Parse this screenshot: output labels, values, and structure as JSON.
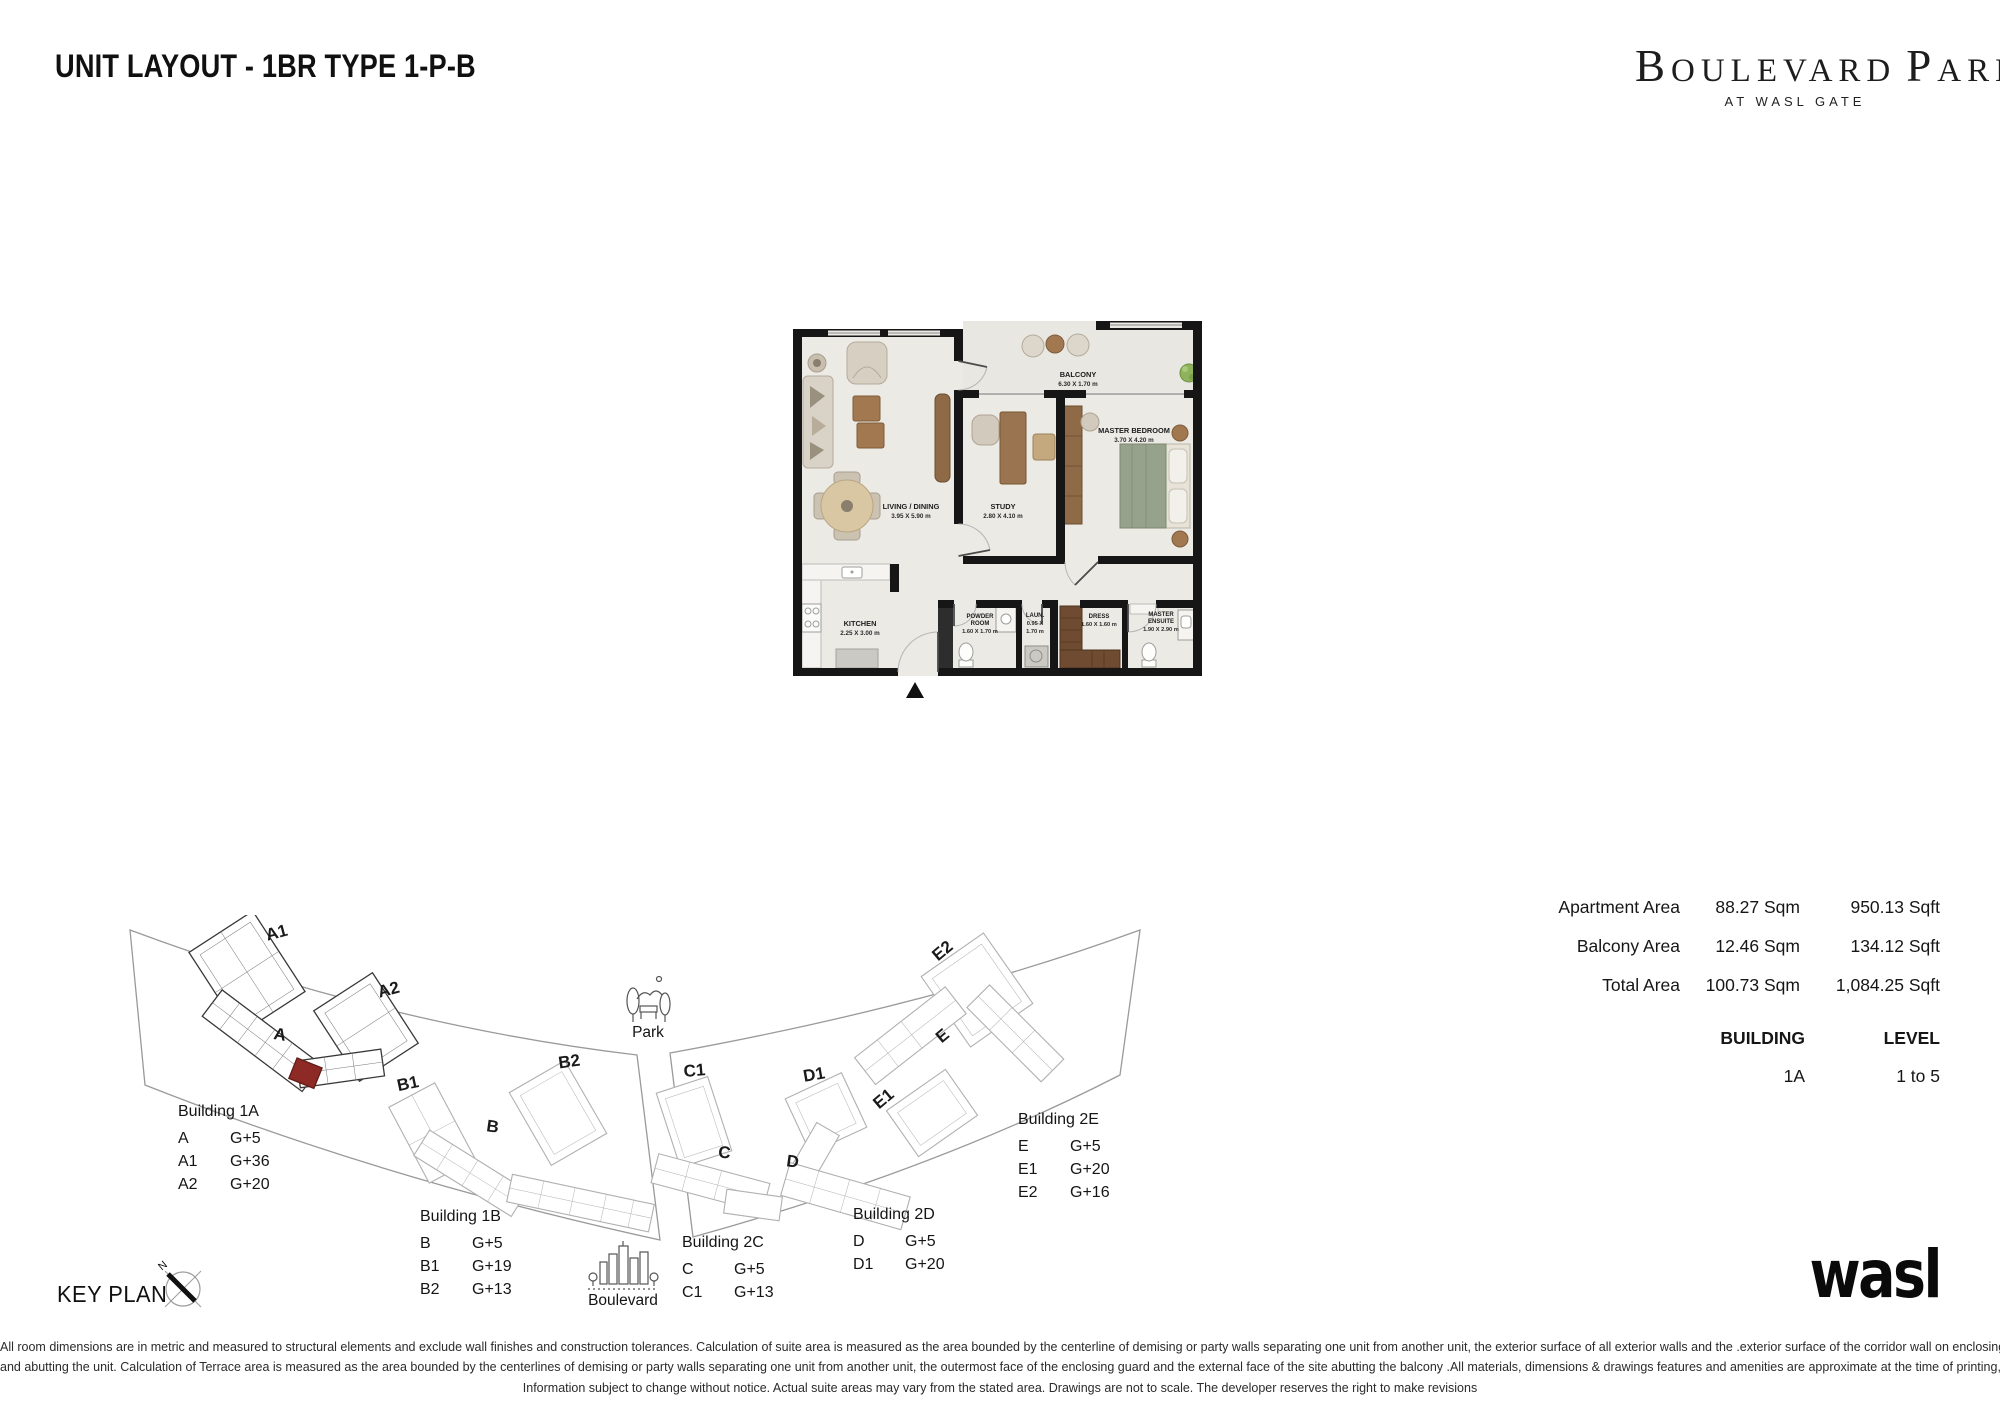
{
  "header": {
    "title": "UNIT LAYOUT - 1BR TYPE 1-P-B",
    "brand_word1": "BOULEVARD",
    "brand_word2": "PARK",
    "brand_tagline": "AT WASL GATE"
  },
  "plan": {
    "rooms": {
      "balcony": {
        "name": "BALCONY",
        "dim": "6.30 X 1.70 m"
      },
      "master": {
        "name": "MASTER BEDROOM",
        "dim": "3.70 X 4.20 m"
      },
      "living": {
        "name": "LIVING / DINING",
        "dim": "3.95 X 5.90 m"
      },
      "study": {
        "name": "STUDY",
        "dim": "2.80 X 4.10 m"
      },
      "kitchen": {
        "name": "KITCHEN",
        "dim": "2.25 X 3.00 m"
      },
      "powder": {
        "line1": "POWDER",
        "line2": "ROOM",
        "dim": "1.60 X 1.70 m"
      },
      "laundry": {
        "name": "LAUN.",
        "dim1": "0.95 X",
        "dim2": "1.70 m"
      },
      "dress": {
        "name": "DRESS",
        "dim": "1.60 X 1.60 m"
      },
      "ensuite": {
        "line1": "MASTER",
        "line2": "ENSUITE",
        "dim": "1.90 X 2.90 m"
      }
    }
  },
  "areas": {
    "rows": [
      {
        "label": "Apartment Area",
        "sqm": "88.27 Sqm",
        "sqft": "950.13 Sqft"
      },
      {
        "label": "Balcony Area",
        "sqm": "12.46 Sqm",
        "sqft": "134.12 Sqft"
      },
      {
        "label": "Total Area",
        "sqm": "100.73 Sqm",
        "sqft": "1,084.25 Sqft"
      }
    ],
    "building_header": "BUILDING",
    "level_header": "LEVEL",
    "building_value": "1A",
    "level_value": "1 to 5"
  },
  "keyplan": {
    "title": "KEY PLAN",
    "compass_n": "N",
    "towers": {
      "a1": "A1",
      "a2": "A2",
      "a": "A",
      "b1": "B1",
      "b2": "B2",
      "b": "B",
      "c1": "C1",
      "c": "C",
      "d1": "D1",
      "d": "D",
      "e1": "E1",
      "e2": "E2",
      "e": "E"
    },
    "poi": {
      "park": "Park",
      "boulevard": "Boulevard"
    },
    "blocks": [
      {
        "title": "Building 1A",
        "rows": [
          {
            "code": "A",
            "floors": "G+5"
          },
          {
            "code": "A1",
            "floors": "G+36"
          },
          {
            "code": "A2",
            "floors": "G+20"
          }
        ]
      },
      {
        "title": "Building 1B",
        "rows": [
          {
            "code": "B",
            "floors": "G+5"
          },
          {
            "code": "B1",
            "floors": "G+19"
          },
          {
            "code": "B2",
            "floors": "G+13"
          }
        ]
      },
      {
        "title": "Building 2C",
        "rows": [
          {
            "code": "C",
            "floors": "G+5"
          },
          {
            "code": "C1",
            "floors": "G+13"
          }
        ]
      },
      {
        "title": "Building 2D",
        "rows": [
          {
            "code": "D",
            "floors": "G+5"
          },
          {
            "code": "D1",
            "floors": "G+20"
          }
        ]
      },
      {
        "title": "Building 2E",
        "rows": [
          {
            "code": "E",
            "floors": "G+5"
          },
          {
            "code": "E1",
            "floors": "G+20"
          },
          {
            "code": "E2",
            "floors": "G+16"
          }
        ]
      }
    ]
  },
  "footer": {
    "logo": "wasl",
    "disclaimer_lines": [
      "All room dimensions are in metric and measured to structural elements and exclude wall finishes and construction tolerances. Calculation of suite area is measured as the area bounded by the centerline of demising or party walls separating one unit from another unit, the exterior surface of all exterior walls and the .exterior surface of the corridor wall on enclosing",
      "and abutting the unit. Calculation of Terrace area is measured as the area bounded by the centerlines of demising or party walls separating one unit from another unit, the outermost face of the enclosing guard and the external face of the site abutting the balcony .All materials, dimensions & drawings features and amenities are approximate at the time of printing,",
      "Information subject to change without notice. Actual suite areas may vary from the stated area. Drawings are not to scale. The developer reserves the right to make revisions"
    ]
  },
  "colors": {
    "highlight_unit": "#8E2A25",
    "wall": "#161616"
  }
}
